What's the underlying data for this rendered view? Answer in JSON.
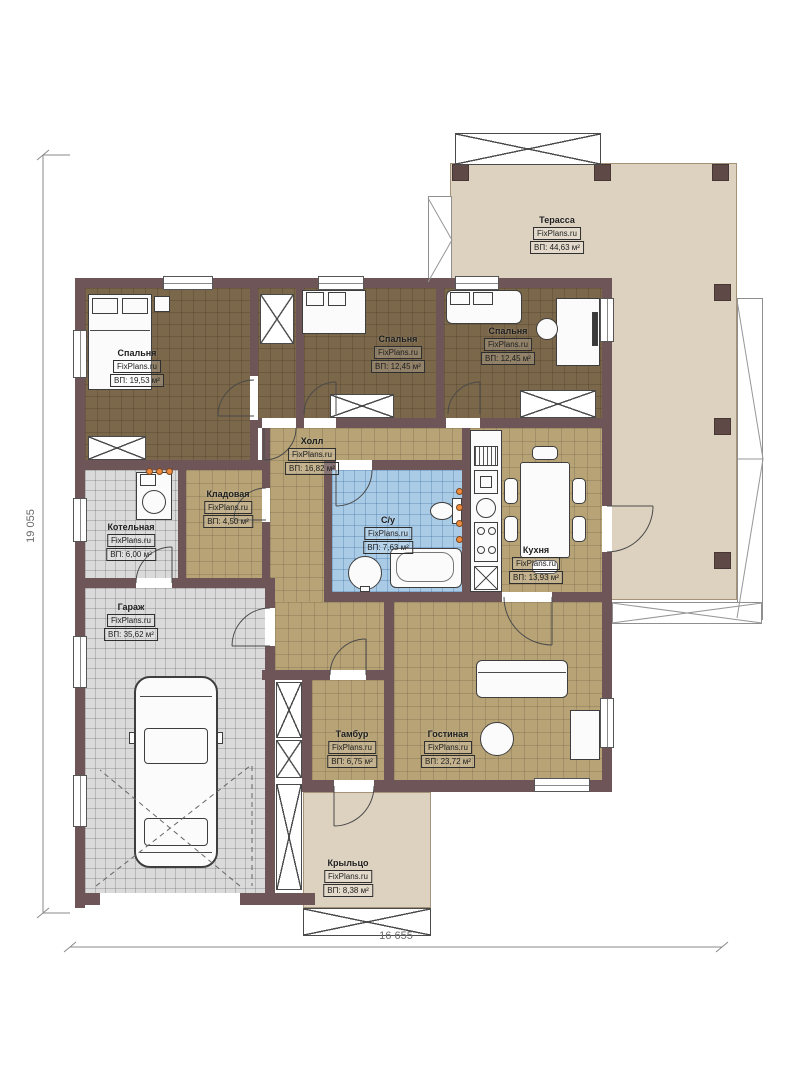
{
  "brand": "FixPlans.ru",
  "plan": {
    "dimension_left": "19 055",
    "dimension_bottom": "16 655"
  },
  "rooms": [
    {
      "id": "terrace",
      "name": "Терасса",
      "area": "ВП: 44,63 м²"
    },
    {
      "id": "bedroom-1",
      "name": "Спальня",
      "area": "ВП: 19,53 м²"
    },
    {
      "id": "bedroom-2",
      "name": "Спальня",
      "area": "ВП: 12,45 м²"
    },
    {
      "id": "bedroom-3",
      "name": "Спальня",
      "area": "ВП: 12,45 м²"
    },
    {
      "id": "hall",
      "name": "Холл",
      "area": "ВП: 16,82 м²"
    },
    {
      "id": "storage",
      "name": "Кладовая",
      "area": "ВП: 4,50 м²"
    },
    {
      "id": "boiler",
      "name": "Котельная",
      "area": "ВП: 6,00 м²"
    },
    {
      "id": "bathroom",
      "name": "С/у",
      "area": "ВП: 7,63 м²"
    },
    {
      "id": "kitchen",
      "name": "Кухня",
      "area": "ВП: 13,93 м²"
    },
    {
      "id": "garage",
      "name": "Гараж",
      "area": "ВП: 35,62 м²"
    },
    {
      "id": "vestibule",
      "name": "Тамбур",
      "area": "ВП: 6,75 м²"
    },
    {
      "id": "living-room",
      "name": "Гостиная",
      "area": "ВП: 23,72 м²"
    },
    {
      "id": "porch",
      "name": "Крыльцо",
      "area": "ВП: 8,38 м²"
    }
  ],
  "colors": {
    "wall": "#6e5557",
    "floor-dark": "#7b6749",
    "floor-tan": "#b7a376",
    "floor-blue": "#a9cbe6",
    "floor-gray": "#dadada",
    "terrace": "#ddd2c0",
    "accent-socket": "#f08a3c",
    "label": "#1d1d1d"
  }
}
